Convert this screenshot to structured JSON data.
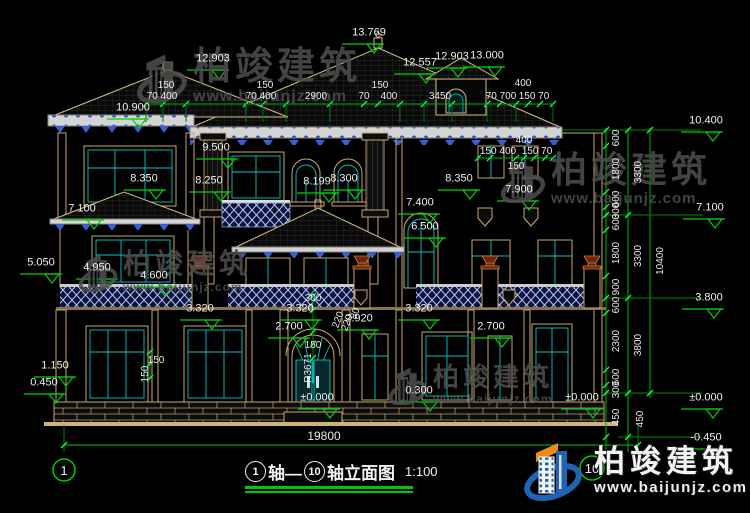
{
  "drawing_title": {
    "axis_start": "1",
    "axis_mid": "轴—",
    "axis_end": "10",
    "suffix": "轴立面图",
    "scale": "1:100"
  },
  "brand": {
    "name": "柏竣建筑",
    "url": "www.baijunjz.com"
  },
  "bottom_dimension": {
    "total_width": "19800"
  },
  "colors": {
    "dim_green": "#00C800",
    "tick_green": "#00FF55",
    "line_tan": "#C9A96A",
    "glass_cyan": "#00C8C8",
    "balustrade_blue": "#2B4BC8",
    "eave_band": "#D4D4D4",
    "logo_blue": "#1E63B4",
    "logo_orange": "#EE8A18",
    "text": "#E9E9E9",
    "background": "#000000"
  },
  "dim_labels": [
    {
      "t": "150",
      "x": 166,
      "y": 86
    },
    {
      "t": "70 400",
      "x": 162,
      "y": 97
    },
    {
      "t": "150",
      "x": 265,
      "y": 86
    },
    {
      "t": "70 400",
      "x": 261,
      "y": 97
    },
    {
      "t": "2900",
      "x": 316,
      "y": 97
    },
    {
      "t": "70",
      "x": 364,
      "y": 97
    },
    {
      "t": "150",
      "x": 380,
      "y": 86
    },
    {
      "t": "400",
      "x": 389,
      "y": 97
    },
    {
      "t": "3450",
      "x": 440,
      "y": 97
    },
    {
      "t": "400",
      "x": 523,
      "y": 84
    },
    {
      "t": "70 700",
      "x": 501,
      "y": 97
    },
    {
      "t": "150 70",
      "x": 534,
      "y": 97
    },
    {
      "t": "400",
      "x": 524,
      "y": 141
    },
    {
      "t": "150 400",
      "x": 498,
      "y": 152
    },
    {
      "t": "150 70",
      "x": 537,
      "y": 152
    },
    {
      "t": "150",
      "x": 516,
      "y": 167
    },
    {
      "t": "300",
      "x": 313,
      "y": 299
    },
    {
      "t": "150",
      "x": 313,
      "y": 346
    },
    {
      "t": "150",
      "x": 156,
      "y": 361
    },
    {
      "t": "150",
      "x": 146,
      "y": 374,
      "rot": -90
    },
    {
      "t": "220",
      "x": 339,
      "y": 320,
      "rot": -70
    },
    {
      "t": "220",
      "x": 348,
      "y": 323,
      "rot": -70
    },
    {
      "t": "80",
      "x": 356,
      "y": 314,
      "rot": -70
    },
    {
      "t": "R3671",
      "x": 309,
      "y": 368,
      "rot": -90
    },
    {
      "t": "19800",
      "x": 324,
      "y": 436,
      "size": 12
    },
    {
      "t": "600",
      "x": 617,
      "y": 138,
      "rot": -90
    },
    {
      "t": "1800",
      "x": 617,
      "y": 169,
      "rot": -90
    },
    {
      "t": "600",
      "x": 617,
      "y": 199,
      "rot": -90
    },
    {
      "t": "300",
      "x": 617,
      "y": 211,
      "rot": -90
    },
    {
      "t": "600",
      "x": 617,
      "y": 222,
      "rot": -90
    },
    {
      "t": "1800",
      "x": 617,
      "y": 253,
      "rot": -90
    },
    {
      "t": "900",
      "x": 617,
      "y": 287,
      "rot": -90
    },
    {
      "t": "600",
      "x": 617,
      "y": 305,
      "rot": -90
    },
    {
      "t": "2300",
      "x": 617,
      "y": 341,
      "rot": -90
    },
    {
      "t": "600",
      "x": 617,
      "y": 377,
      "rot": -90
    },
    {
      "t": "300",
      "x": 617,
      "y": 390,
      "rot": -90
    },
    {
      "t": "450",
      "x": 617,
      "y": 417,
      "rot": -90
    },
    {
      "t": "3300",
      "x": 639,
      "y": 172,
      "rot": -90
    },
    {
      "t": "3300",
      "x": 639,
      "y": 256,
      "rot": -90
    },
    {
      "t": "3800",
      "x": 639,
      "y": 345,
      "rot": -90
    },
    {
      "t": "450",
      "x": 641,
      "y": 419,
      "rot": -90
    },
    {
      "t": "10400",
      "x": 661,
      "y": 261,
      "rot": -90
    }
  ],
  "elevation_markers": [
    {
      "v": "13.769",
      "lx": 369,
      "ly": 33,
      "tx": 374,
      "ty": 44
    },
    {
      "v": "12.903",
      "lx": 213,
      "ly": 59,
      "tx": 219,
      "ty": 70
    },
    {
      "v": "12.557",
      "lx": 420,
      "ly": 63,
      "tx": 426,
      "ty": 74
    },
    {
      "v": "12.903",
      "lx": 452,
      "ly": 57,
      "tx": 458,
      "ty": 68
    },
    {
      "v": "13.000",
      "lx": 487,
      "ly": 56,
      "tx": 495,
      "ty": 67
    },
    {
      "v": "10.900",
      "lx": 133,
      "ly": 108,
      "tx": 139,
      "ty": 119
    },
    {
      "v": "9.500",
      "lx": 216,
      "ly": 148,
      "tx": 228,
      "ty": 159
    },
    {
      "v": "8.350",
      "lx": 144,
      "ly": 179,
      "tx": 156,
      "ty": 190
    },
    {
      "v": "8.250",
      "lx": 209,
      "ly": 181,
      "tx": 221,
      "ty": 192
    },
    {
      "v": "8.199",
      "lx": 317,
      "ly": 182,
      "tx": 329,
      "ty": 193
    },
    {
      "v": "8.300",
      "lx": 344,
      "ly": 179,
      "tx": 355,
      "ty": 190
    },
    {
      "v": "8.350",
      "lx": 459,
      "ly": 179,
      "tx": 470,
      "ty": 190
    },
    {
      "v": "7.900",
      "lx": 519,
      "ly": 190,
      "tx": 529,
      "ty": 201
    },
    {
      "v": "7.100",
      "lx": 82,
      "ly": 209,
      "tx": 94,
      "ty": 220
    },
    {
      "v": "7.400",
      "lx": 420,
      "ly": 203,
      "tx": 430,
      "ty": 214
    },
    {
      "v": "6.500",
      "lx": 425,
      "ly": 227,
      "tx": 436,
      "ty": 238
    },
    {
      "v": "5.050",
      "lx": 41,
      "ly": 263,
      "tx": 52,
      "ty": 274
    },
    {
      "v": "4.950",
      "lx": 97,
      "ly": 268,
      "tx": 108,
      "ty": 279
    },
    {
      "v": "4.600",
      "lx": 154,
      "ly": 276,
      "tx": 165,
      "ty": 287
    },
    {
      "v": "3.320",
      "lx": 200,
      "ly": 309,
      "tx": 212,
      "ty": 320
    },
    {
      "v": "3.320",
      "lx": 300,
      "ly": 309,
      "tx": 312,
      "ty": 320
    },
    {
      "v": "3.320",
      "lx": 419,
      "ly": 309,
      "tx": 430,
      "ty": 320
    },
    {
      "v": "2.920",
      "lx": 359,
      "ly": 319,
      "tx": 369,
      "ty": 330
    },
    {
      "v": "2.700",
      "lx": 289,
      "ly": 327,
      "tx": 300,
      "ty": 338
    },
    {
      "v": "2.700",
      "lx": 491,
      "ly": 327,
      "tx": 502,
      "ty": 338
    },
    {
      "v": "1.150",
      "lx": 55,
      "ly": 366,
      "tx": 66,
      "ty": 377
    },
    {
      "v": "0.450",
      "lx": 44,
      "ly": 383,
      "tx": 56,
      "ty": 394
    },
    {
      "v": "0.300",
      "lx": 419,
      "ly": 391,
      "tx": 430,
      "ty": 402
    },
    {
      "v": "±0.000",
      "lx": 317,
      "ly": 398,
      "tx": 330,
      "ty": 409
    },
    {
      "v": "±0.000",
      "lx": 582,
      "ly": 398,
      "tx": 593,
      "ty": 409
    },
    {
      "v": "10.400",
      "lx": 706,
      "ly": 121,
      "tx": 713,
      "ty": 132
    },
    {
      "v": "7.100",
      "lx": 710,
      "ly": 208,
      "tx": 715,
      "ty": 219
    },
    {
      "v": "3.800",
      "lx": 709,
      "ly": 298,
      "tx": 714,
      "ty": 309
    },
    {
      "v": "±0.000",
      "lx": 706,
      "ly": 398,
      "tx": 713,
      "ty": 409
    },
    {
      "v": "-0.450",
      "lx": 706,
      "ly": 438,
      "tx": 713,
      "ty": 449
    }
  ]
}
